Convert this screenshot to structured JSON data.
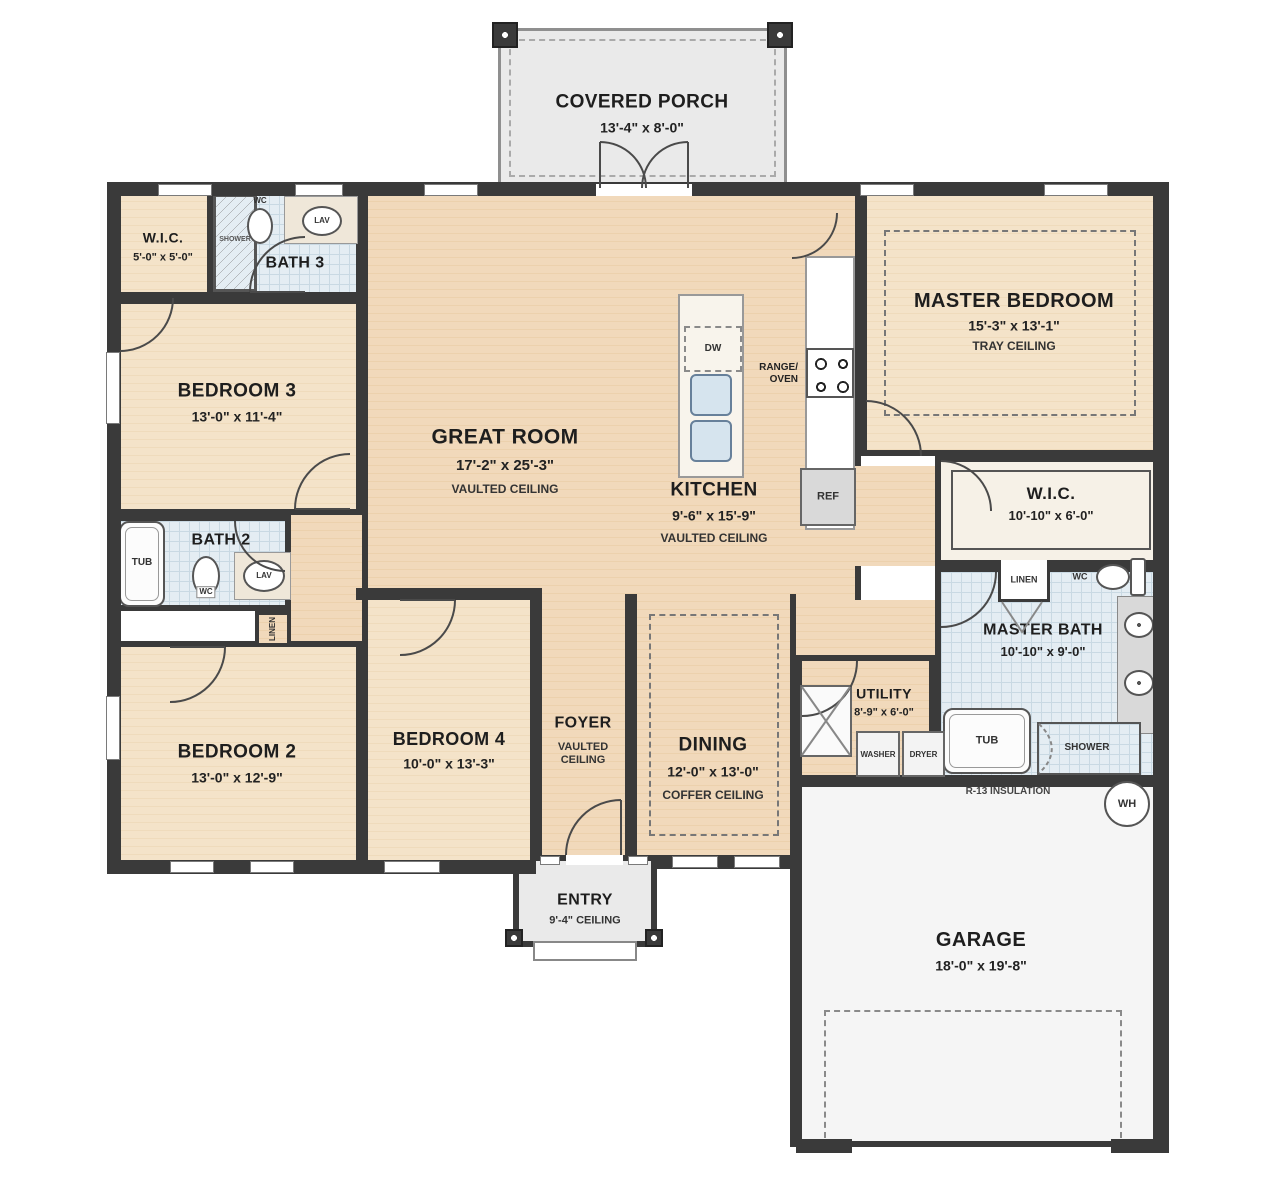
{
  "rooms": {
    "covered_porch": {
      "name": "COVERED PORCH",
      "dims": "13'-4\" x 8'-0\""
    },
    "wic3": {
      "name": "W.I.C.",
      "dims": "5'-0\" x 5'-0\""
    },
    "bath3": {
      "name": "BATH 3"
    },
    "bedroom3": {
      "name": "BEDROOM 3",
      "dims": "13'-0\" x 11'-4\""
    },
    "great_room": {
      "name": "GREAT ROOM",
      "dims": "17'-2\" x 25'-3\"",
      "note": "VAULTED CEILING"
    },
    "kitchen": {
      "name": "KITCHEN",
      "dims": "9'-6\" x 15'-9\"",
      "note": "VAULTED CEILING"
    },
    "master_bedroom": {
      "name": "MASTER BEDROOM",
      "dims": "15'-3\" x 13'-1\"",
      "note": "TRAY CEILING"
    },
    "master_wic": {
      "name": "W.I.C.",
      "dims": "10'-10\" x 6'-0\""
    },
    "master_bath": {
      "name": "MASTER BATH",
      "dims": "10'-10\" x 9'-0\""
    },
    "bath2": {
      "name": "BATH 2"
    },
    "bedroom2": {
      "name": "BEDROOM 2",
      "dims": "13'-0\" x 12'-9\""
    },
    "bedroom4": {
      "name": "BEDROOM 4",
      "dims": "10'-0\" x 13'-3\""
    },
    "foyer": {
      "name": "FOYER",
      "note": "VAULTED CEILING"
    },
    "dining": {
      "name": "DINING",
      "dims": "12'-0\" x 13'-0\"",
      "note": "COFFER CEILING"
    },
    "utility": {
      "name": "UTILITY",
      "dims": "8'-9\" x 6'-0\""
    },
    "entry": {
      "name": "ENTRY",
      "note": "9'-4\" CEILING"
    },
    "garage": {
      "name": "GARAGE",
      "dims": "18'-0\" x 19'-8\""
    }
  },
  "fixtures": {
    "shower_bath3": "SHOWER",
    "wc_bath3": "WC",
    "lav_bath3": "LAV",
    "tub_bath2": "TUB",
    "wc_bath2": "WC",
    "lav_bath2": "LAV",
    "linen_hall": "LINEN",
    "dw": "DW",
    "range_oven": "RANGE/\nOVEN",
    "ref": "REF",
    "linen_master": "LINEN",
    "wc_master": "WC",
    "tub_master": "TUB",
    "shower_master": "SHOWER",
    "washer": "WASHER",
    "dryer": "DRYER",
    "insulation": "R-13 INSULATION",
    "wh": "WH"
  },
  "colors": {
    "wall": "#3a3a3a",
    "wood_floor": "#f0d8ba",
    "bedroom_floor": "#f3e2c8",
    "tile_floor": "#e4edf3",
    "porch_floor": "#eaeaea",
    "garage_floor": "#f5f5f5"
  }
}
